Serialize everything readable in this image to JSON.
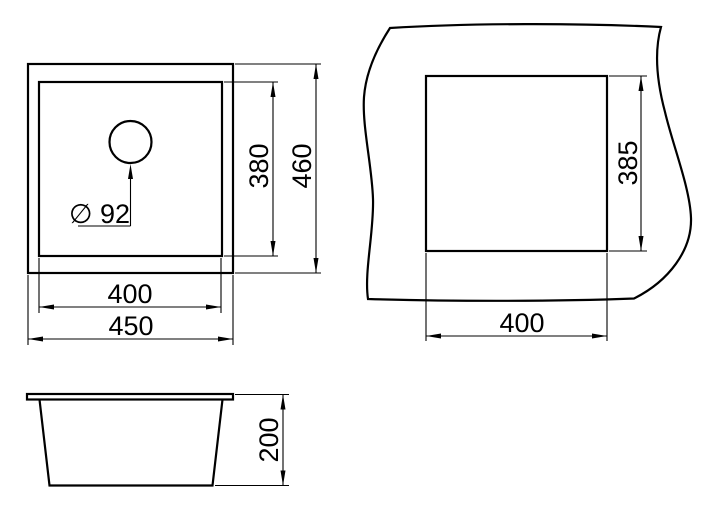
{
  "colors": {
    "line": "#000000",
    "background": "#ffffff"
  },
  "views": {
    "plan": {
      "dimensions": {
        "inner_width": "400",
        "outer_width": "450",
        "inner_depth": "380",
        "outer_depth": "460",
        "drain_diameter": "∅ 92"
      }
    },
    "cutout": {
      "dimensions": {
        "width": "400",
        "height": "385"
      }
    },
    "side": {
      "dimensions": {
        "depth": "200"
      }
    }
  }
}
